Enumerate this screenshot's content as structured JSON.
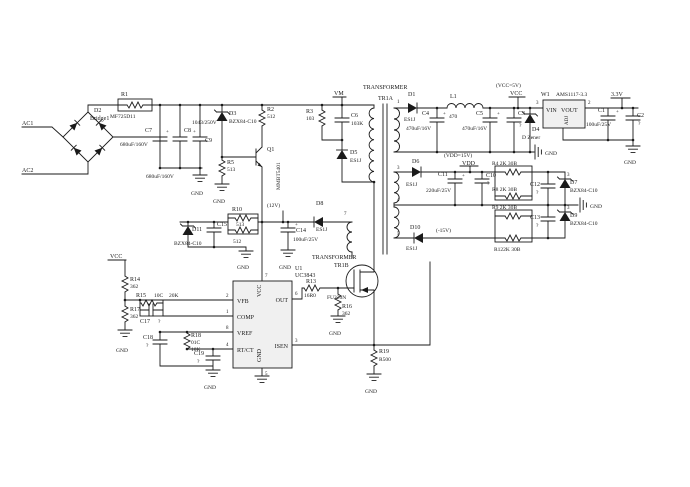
{
  "nets": {
    "ac1": "AC1",
    "ac2": "AC2",
    "vm": "VM",
    "vcc": "VCC",
    "vcc5": "(VCC=5V)",
    "vdd": "VDD",
    "vdd15": "(VDD=15V)",
    "v12": "(12V)",
    "vn15": "(-15V)",
    "v33": "3.3V",
    "gnd": "GND"
  },
  "bridge": {
    "ref": "D2",
    "part": "Bridge1"
  },
  "xfmr": {
    "label": "TRANSFORMER",
    "top": "TR1A",
    "bot": "TR1B",
    "p1": "1",
    "p3": "3",
    "p4": "4",
    "p5": "5",
    "p7": "7"
  },
  "u1": {
    "ref": "U1",
    "part": "UC3843",
    "vfb": "VFB",
    "comp": "COMP",
    "vref": "VREF",
    "rtct": "RT/CT",
    "out": "OUT",
    "isen": "ISEN",
    "vcc": "VCC",
    "gnd": "GND",
    "p1": "1",
    "p2": "2",
    "p3": "3",
    "p4": "4",
    "p5": "5",
    "p6": "6",
    "p7": "7",
    "p8": "8"
  },
  "w1": {
    "ref": "W1",
    "part": "AMS1117-3.3",
    "vin": "VIN",
    "vout": "VOUT",
    "adj": "ADJ",
    "p2": "2",
    "p3": "3"
  },
  "q1": {
    "ref": "Q1",
    "part": "MMBT5401"
  },
  "q2": {
    "part": "FU220N"
  },
  "res": {
    "r1": "R1",
    "r1v": "MF725D11",
    "r2": "R2",
    "r2v": "512",
    "r3": "R3",
    "r3v": "103",
    "r4": "R4 2K 30B",
    "r5": "R5",
    "r5v": "513",
    "r8": "R8 2K 30B",
    "r9": "R9 2K 30B",
    "r10": "R10",
    "r10a": "513",
    "r10b": "512",
    "r12": "R122K 30B",
    "r13": "R13",
    "r13v": "16R0",
    "r14": "R14",
    "r14v": "362",
    "r15": "R15",
    "r15a": "10C",
    "r15v": "20K",
    "r16": "R16",
    "r16v": "362",
    "r17": "R17",
    "r17v": "362",
    "r18": "R18",
    "r18a": "01C",
    "r18v": "10K",
    "r19": "R19",
    "r19v": "R500"
  },
  "cap": {
    "plus": "+",
    "c1": "C1",
    "c1v": "100uF/25V",
    "c2": "C2",
    "c2v": "?",
    "c3": "C3",
    "c3v": "?",
    "c4": "C4",
    "c4v": "470uF/16V",
    "c5": "C5",
    "c5v": "470uF/16V",
    "c6": "C6",
    "c6v": "103K",
    "c7": "C7",
    "c7v": "680uF/160V",
    "c8": "C8",
    "c8v": "680uF/160V",
    "c9": "C9",
    "c9v": "1043/250V",
    "c10": "C10",
    "c10v": "?",
    "c11": "C11",
    "c11v": "220uF/25V",
    "c12": "C12",
    "c12v": "?",
    "c13": "C13",
    "c13v": "?",
    "c14": "C14",
    "c14v": "100uF/25V",
    "c15": "C15",
    "c17": "C17",
    "c17v": "?",
    "c18": "C18",
    "c18v": "?",
    "c19": "C19",
    "c19v": "?"
  },
  "dio": {
    "d1": "D1",
    "d1v": "ES1J",
    "d3": "D3",
    "d3v": "BZX84-C10",
    "d4": "D4",
    "d4v": "D Zener",
    "d5": "D5",
    "d5v": "ES1J",
    "d6": "D6",
    "d6v": "ES1J",
    "d7": "D7",
    "d7v": "BZX84-C10",
    "d8": "D8",
    "d8v": "ES1J",
    "d9": "D9",
    "d9v": "BZX84-C10",
    "d10": "D10",
    "d10v": "ES1J",
    "d11": "D11",
    "d11v": "BZX84-C10",
    "p3": "3"
  },
  "ind": {
    "l1": "L1",
    "l1v": "470"
  }
}
